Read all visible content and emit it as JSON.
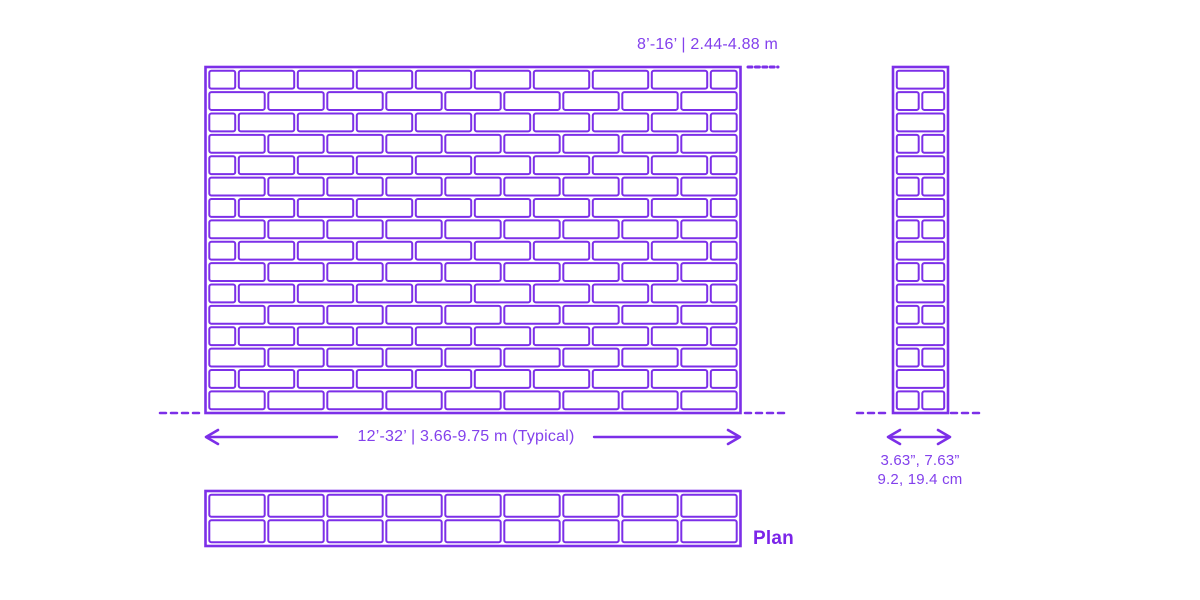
{
  "colors": {
    "accent_line": "#7C2FE8",
    "accent_text": "#8341EC",
    "background": "#FFFFFF"
  },
  "annotations": {
    "height_dimension": "8’-16’ | 2.44-4.88 m",
    "width_dimension": "12’-32’ | 3.66-9.75 m (Typical)",
    "thickness_dimension_imperial": "3.63”, 7.63”",
    "thickness_dimension_metric": "9.2, 19.4 cm",
    "plan_label": "Plan"
  },
  "elevation_view": {
    "description": "running-bond brick wall elevation",
    "courses": 16,
    "stretchers_per_course": 9,
    "odd_courses_start_with": "half-brick",
    "even_courses_start_with": "full-brick"
  },
  "section_view": {
    "description": "wall section pier, alternating stretcher and header courses",
    "courses": 16,
    "odd_courses": "full",
    "even_courses": "split"
  },
  "plan_view": {
    "rows": 2,
    "columns": 9
  }
}
